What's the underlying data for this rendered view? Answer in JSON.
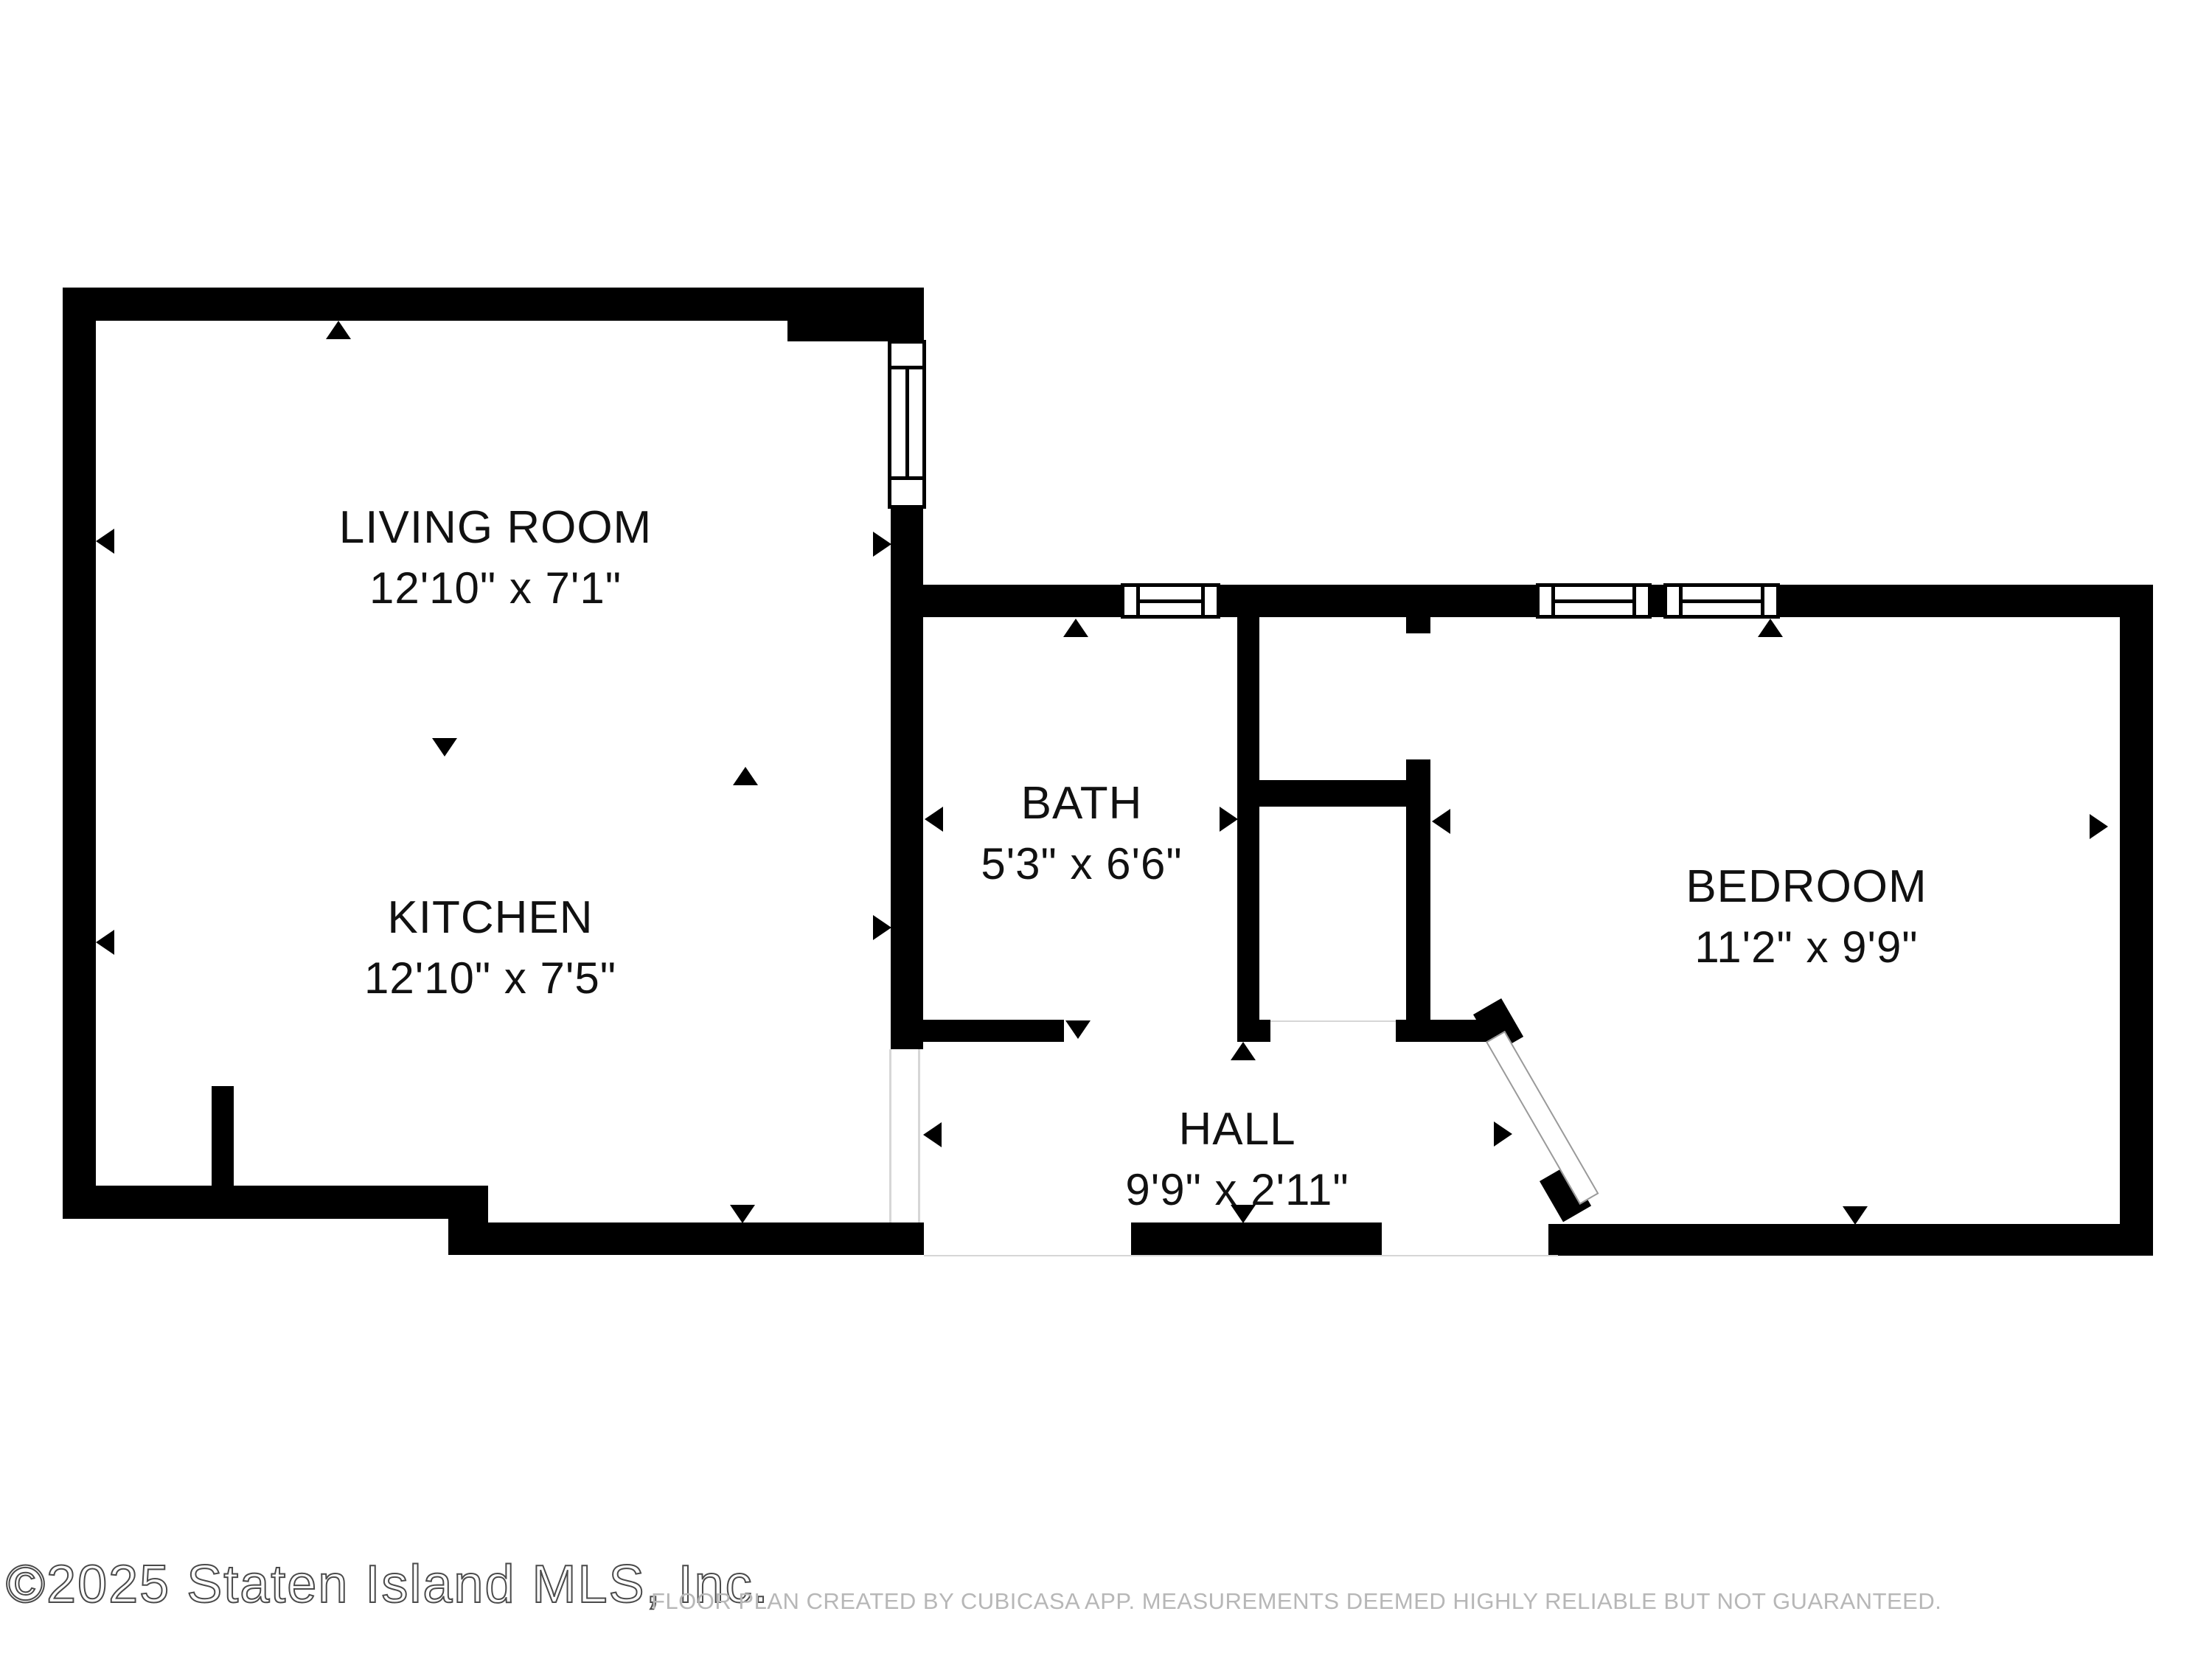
{
  "plan": {
    "type": "floor-plan",
    "colors": {
      "wall": "#000000",
      "label_text": "#111111",
      "disclaimer_text": "#b7b7b7",
      "watermark_outline": "#4a4a4a",
      "background": "#ffffff"
    },
    "rooms": {
      "living_room": {
        "name": "LIVING ROOM",
        "dims": "12'10\" x 7'1\""
      },
      "kitchen": {
        "name": "KITCHEN",
        "dims": "12'10\" x 7'5\""
      },
      "bath": {
        "name": "BATH",
        "dims": "5'3\" x 6'6\""
      },
      "bedroom": {
        "name": "BEDROOM",
        "dims": "11'2\" x 9'9\""
      },
      "hall": {
        "name": "HALL",
        "dims": "9'9\" x 2'11\""
      }
    },
    "footer": {
      "watermark": "©2025 Staten Island MLS, Inc.",
      "disclaimer": "FLOOR PLAN CREATED BY CUBICASA APP. MEASUREMENTS DEEMED HIGHLY RELIABLE BUT NOT GUARANTEED."
    }
  }
}
